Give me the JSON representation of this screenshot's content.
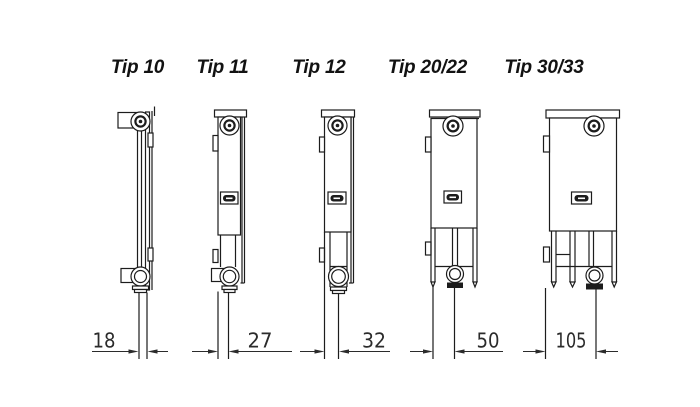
{
  "diagram": {
    "background": "#ffffff",
    "line_color": "#1c1c1c",
    "text_color": "#121212",
    "columns": [
      {
        "id": "tip-10",
        "label": "Tip 10",
        "dimension_mm": "18"
      },
      {
        "id": "tip-11",
        "label": "Tip 11",
        "dimension_mm": "27"
      },
      {
        "id": "tip-12",
        "label": "Tip 12",
        "dimension_mm": "32"
      },
      {
        "id": "tip-20-22",
        "label": "Tip 20/22",
        "dimension_mm": "50"
      },
      {
        "id": "tip-30-33",
        "label": "Tip 30/33",
        "dimension_mm": "105"
      }
    ]
  }
}
